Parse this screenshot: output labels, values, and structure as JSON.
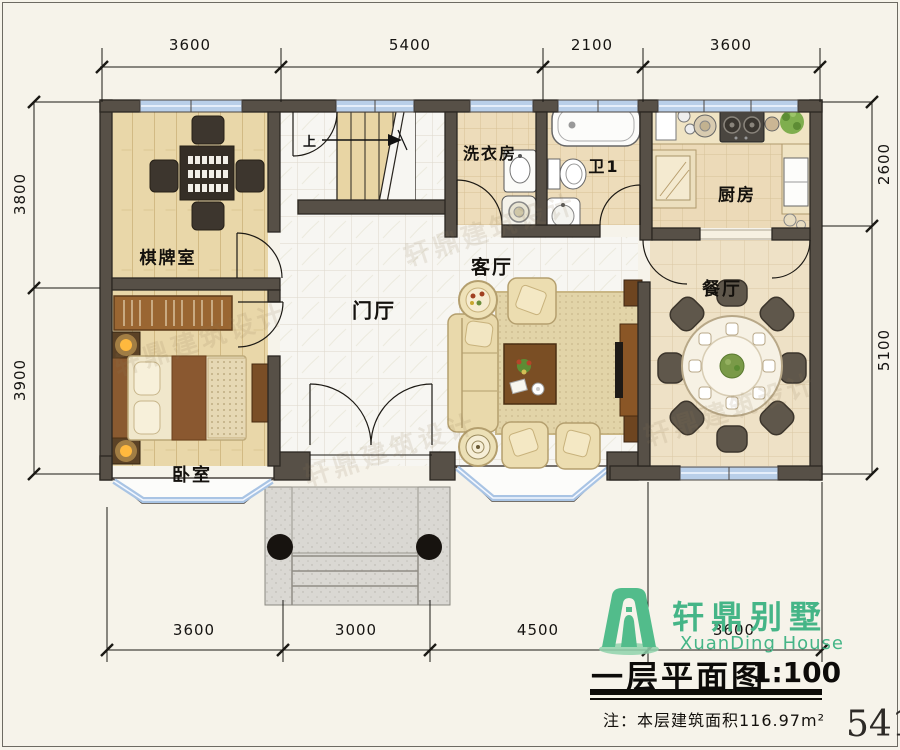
{
  "sheet": {
    "page_number": "541"
  },
  "rooms": {
    "chess": "棋牌室",
    "bedroom": "卧室",
    "foyer": "门厅",
    "living": "客厅",
    "laundry": "洗衣房",
    "bath": "卫1",
    "kitchen": "厨房",
    "dining": "餐厅"
  },
  "stairs": {
    "up_label": "上"
  },
  "dimensions": {
    "top": [
      "3600",
      "5400",
      "2100",
      "3600"
    ],
    "bottom": [
      "3600",
      "3000",
      "4500",
      "3600"
    ],
    "left": [
      "3800",
      "3900"
    ],
    "right": [
      "2600",
      "5100"
    ]
  },
  "title_block": {
    "logo_cn": "轩鼎别墅",
    "logo_en": "XuanDing House",
    "plan_title": "一层平面图",
    "scale": "1:100",
    "note": "注：本层建筑面积116.97m²"
  },
  "watermark": "轩鼎建筑设计",
  "colors": {
    "wall": "#575047",
    "window_blue": "#b9cfe9",
    "logo_green": "#45b587",
    "wood_floor": "#e9d7a9",
    "beige_tile": "#eddcba"
  }
}
